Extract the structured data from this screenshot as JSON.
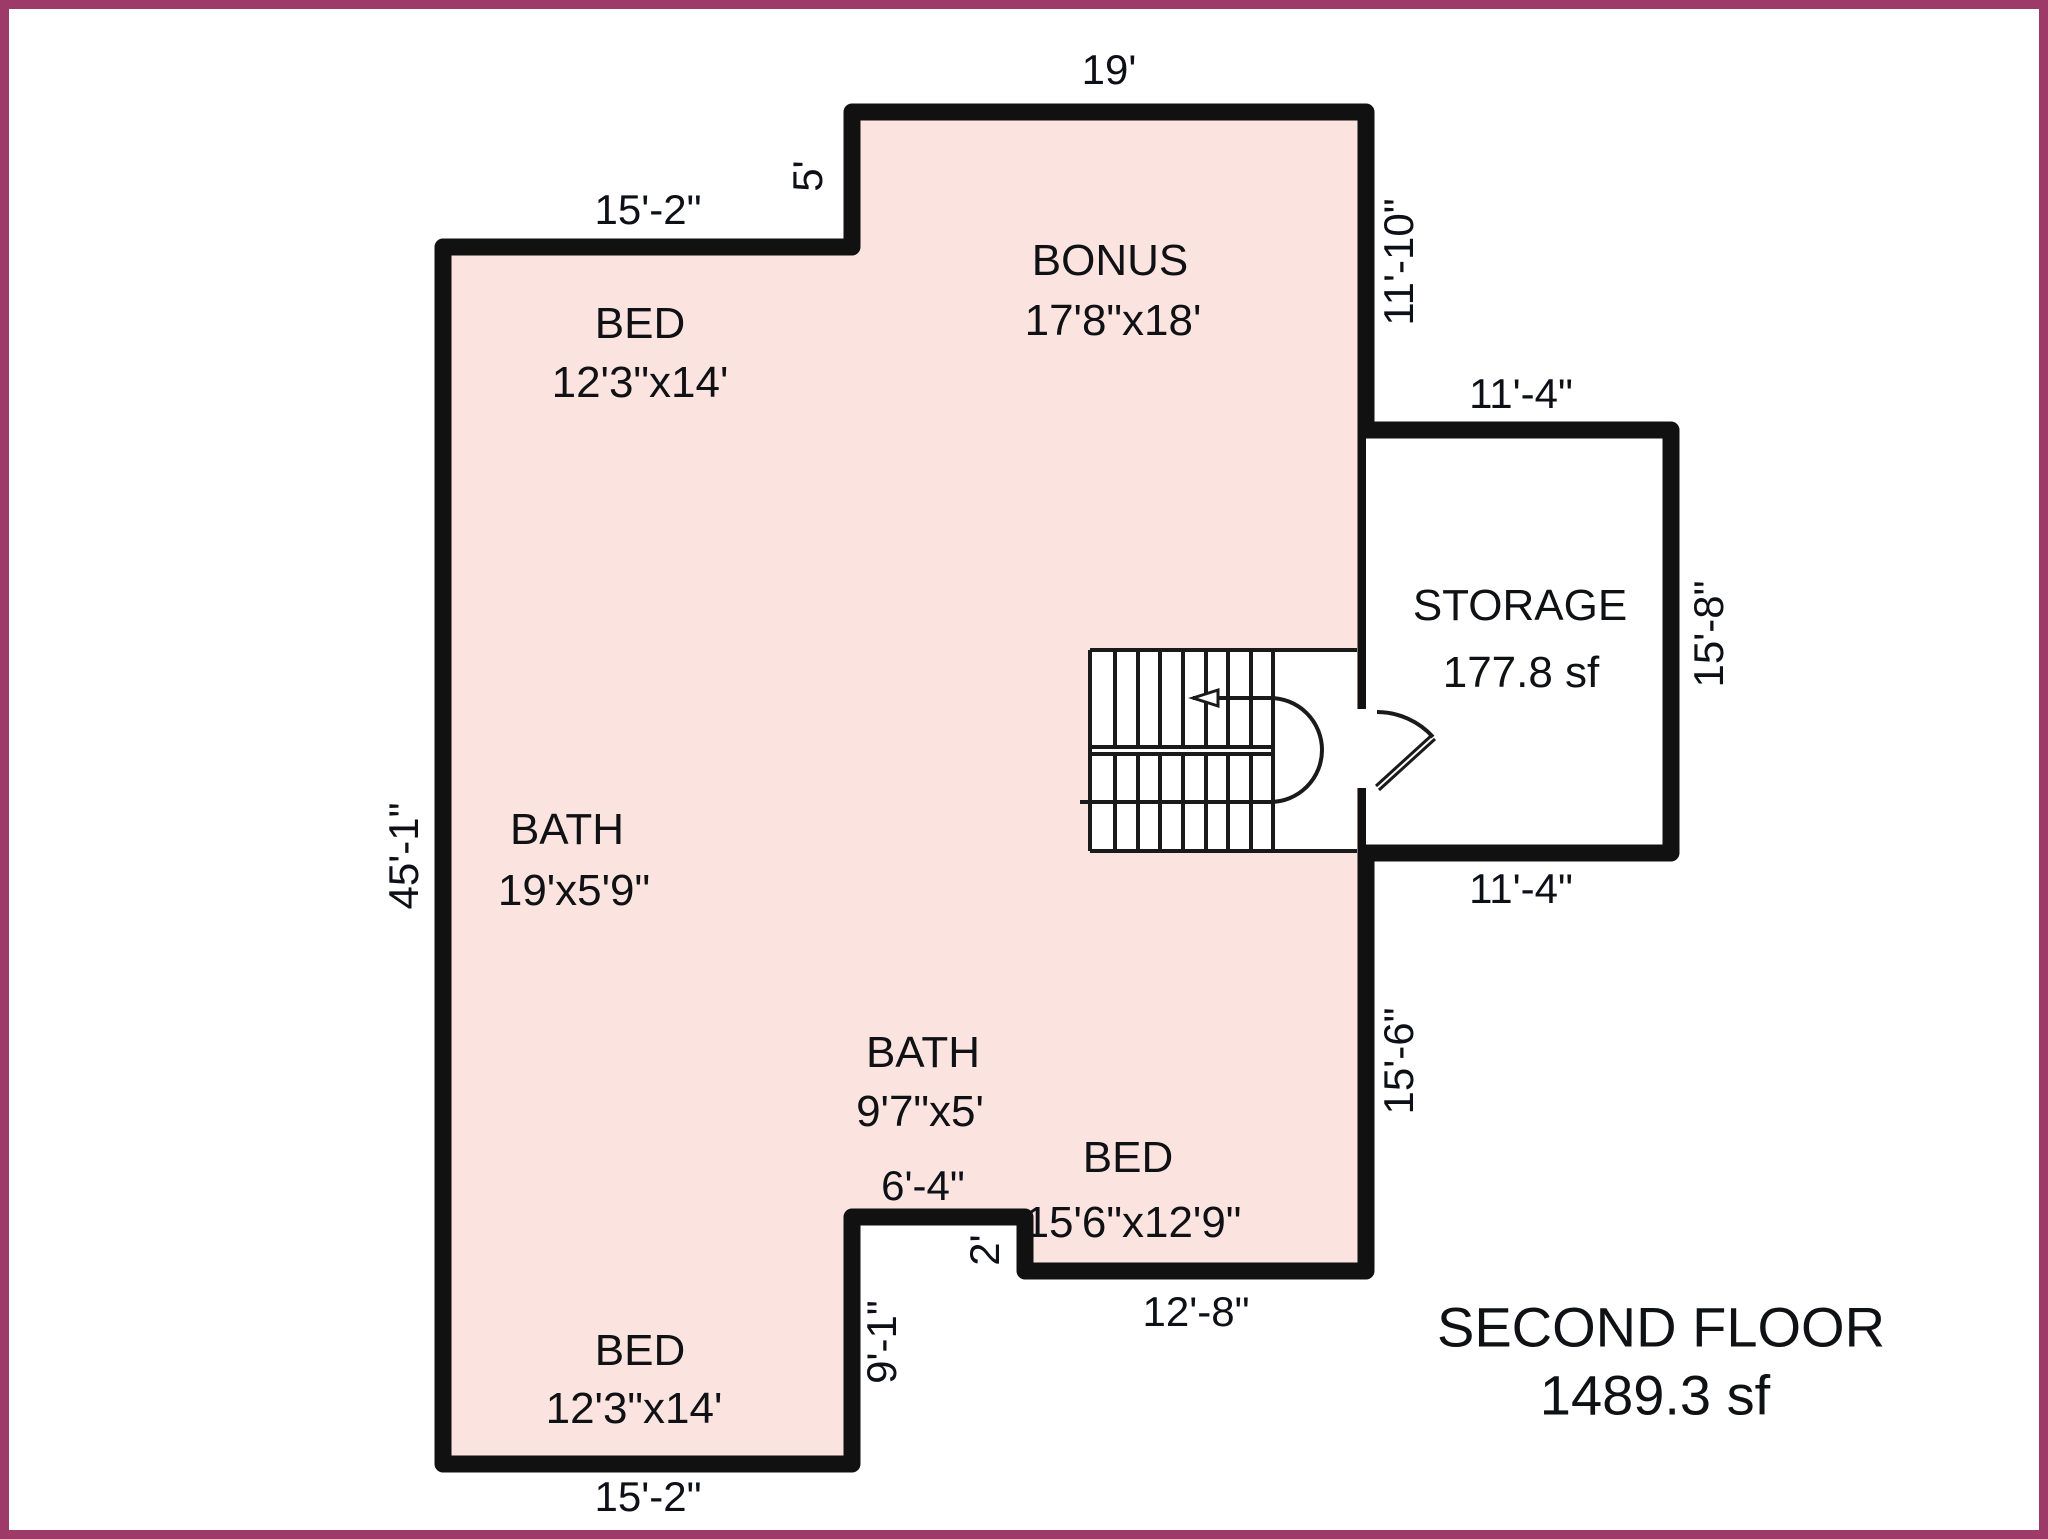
{
  "title": {
    "line1": "SECOND FLOOR",
    "line2": "1489.3 sf"
  },
  "colors": {
    "frame": "#9e3a68",
    "background": "#ffffff",
    "floor_fill": "#fbe4df",
    "wall": "#111111",
    "stair_line": "#1a1a1a"
  },
  "rooms": {
    "bed_top_left": {
      "name": "BED",
      "dims": "12'3\"x14'"
    },
    "bonus": {
      "name": "BONUS",
      "dims": "17'8\"x18'"
    },
    "storage": {
      "name": "STORAGE",
      "dims": "177.8 sf"
    },
    "bath_main": {
      "name": "BATH",
      "dims": "19'x5'9\""
    },
    "bath_small": {
      "name": "BATH",
      "dims": "9'7\"x5'"
    },
    "bed_bottom_right": {
      "name": "BED",
      "dims": "15'6\"x12'9\""
    },
    "bed_bottom_left": {
      "name": "BED",
      "dims": "12'3\"x14'"
    }
  },
  "dimensions": {
    "bonus_top": "19'",
    "top_left_width": "15'-2\"",
    "step_left": "5'",
    "bonus_right": "11'-10\"",
    "storage_top": "11'-4\"",
    "storage_right": "15'-8\"",
    "storage_bottom": "11'-4\"",
    "left_height": "45'-1\"",
    "right_lower": "15'-6\"",
    "notch_top": "6'-4\"",
    "notch_step": "2'",
    "bed_bottom_width": "12'-8\"",
    "notch_right": "9'-1\"",
    "bottom_left_width": "15'-2\""
  }
}
